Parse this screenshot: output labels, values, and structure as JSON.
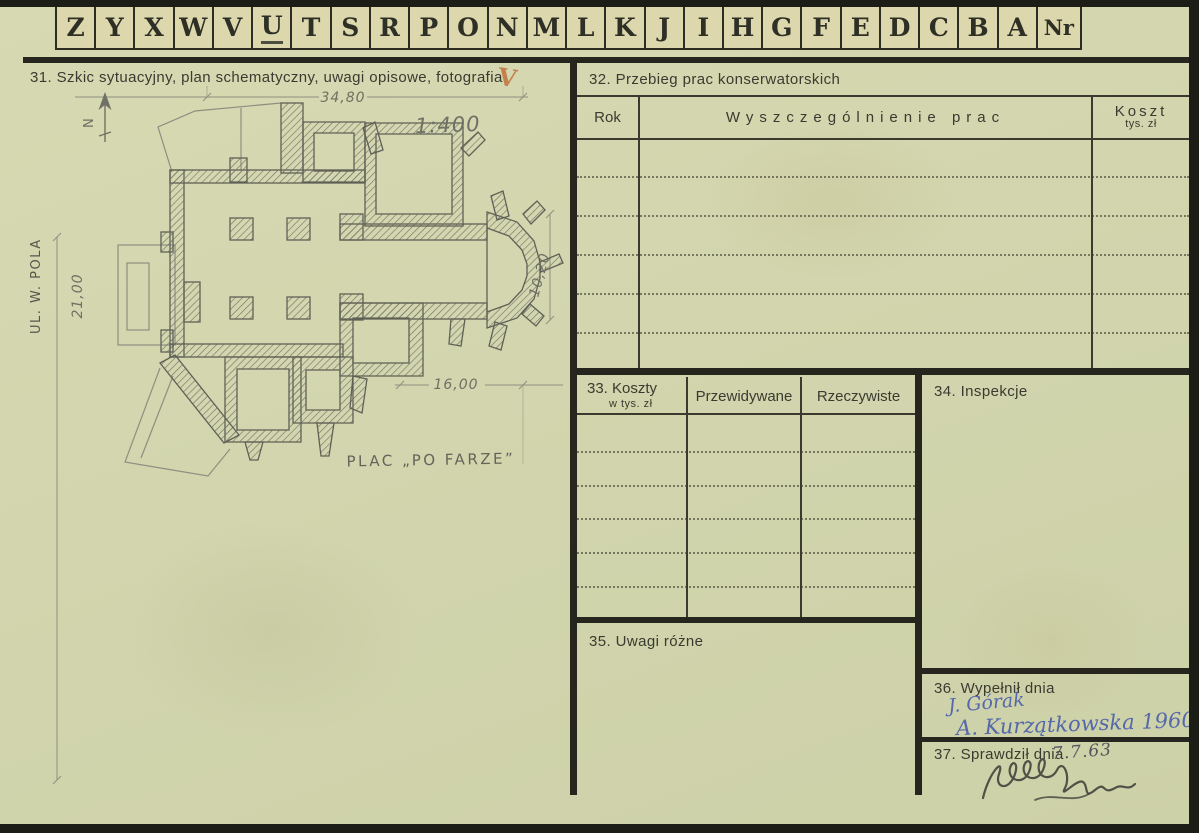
{
  "colors": {
    "paper": "#d3d6ae",
    "print_ink": "#3a3b30",
    "rule_black": "#26261e",
    "pencil": "#6f7164",
    "blue_ink": "#5468ab",
    "check_orange": "#c4713a"
  },
  "tabs": {
    "letters": [
      "Z",
      "Y",
      "X",
      "W",
      "V",
      "U",
      "T",
      "S",
      "R",
      "P",
      "O",
      "N",
      "M",
      "L",
      "K",
      "J",
      "I",
      "H",
      "G",
      "F",
      "E",
      "D",
      "C",
      "B",
      "A"
    ],
    "nr_label": "Nr",
    "underlined_letter": "U"
  },
  "s31": {
    "title": "31. Szkic sytuacyjny, plan schematyczny, uwagi opisowe, fotografia",
    "checkmark": "V",
    "plan": {
      "scale": "1:400",
      "dim_top": "34,80",
      "dim_left": "21,00",
      "dim_right": "10,20",
      "dim_bottom": "16,00",
      "street": "UL. W. POLA",
      "square_label": "PLAC „PO FARZE”",
      "north": "N"
    }
  },
  "s32": {
    "title": "32. Przebieg prac konserwatorskich",
    "col_rok": "Rok",
    "col_prace": "Wyszczególnienie prac",
    "col_koszt": "Koszt",
    "col_koszt_sub": "tys. zł"
  },
  "s33": {
    "title": "33. Koszty",
    "title_sub": "w tys. zł",
    "col_przewidywane": "Przewidywane",
    "col_rzeczywiste": "Rzeczywiste"
  },
  "s34": {
    "title": "34. Inspekcje"
  },
  "s35": {
    "title": "35. Uwagi różne"
  },
  "s36": {
    "title": "36. Wypełnił dnia",
    "entry_line1": "J. Górak",
    "entry_line2": "A. Kurzątkowska 1960"
  },
  "s37": {
    "title": "37. Sprawdził dnia",
    "date": "7.7.63"
  }
}
